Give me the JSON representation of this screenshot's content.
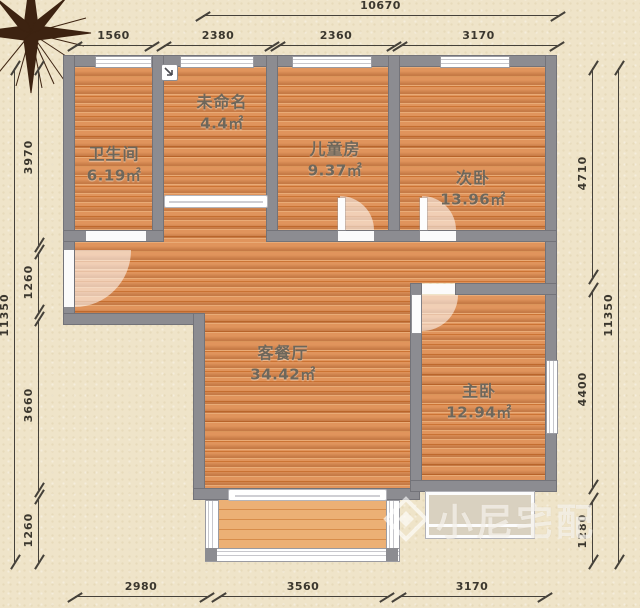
{
  "title": "apartment-floor-plan",
  "rooms": [
    {
      "id": "bathroom",
      "name": "卫生间",
      "area": "6.19㎡"
    },
    {
      "id": "unnamed",
      "name": "未命名",
      "area": "4.4㎡"
    },
    {
      "id": "kids-room",
      "name": "儿童房",
      "area": "9.37㎡"
    },
    {
      "id": "second-bedroom",
      "name": "次卧",
      "area": "13.96㎡"
    },
    {
      "id": "living-dining",
      "name": "客餐厅",
      "area": "34.42㎡"
    },
    {
      "id": "master-bedroom",
      "name": "主卧",
      "area": "12.94㎡"
    }
  ],
  "dimensions": {
    "top": {
      "total": "10670",
      "segments": [
        "1560",
        "2380",
        "2360",
        "3170"
      ]
    },
    "left": {
      "total": "11350",
      "segments": [
        "3970",
        "1260",
        "3660",
        "1260"
      ]
    },
    "right": {
      "total": "11350",
      "segments": [
        "4710",
        "4400",
        "1280"
      ]
    },
    "bottom": {
      "segments": [
        "2980",
        "3560",
        "3170"
      ]
    }
  },
  "watermark": {
    "text": "小尼宅配",
    "logo": "diamond-logo"
  },
  "icons": [
    "compass-rose-icon",
    "diamond-logo-icon",
    "corner-marker-icon"
  ],
  "colors": {
    "background": "#efe4c9",
    "wall": "#8c8c91",
    "floor_wood": "#d98648",
    "balcony_wood": "#ecb075",
    "dimension_text": "#3b372e",
    "room_label": "#6e675b",
    "compass": "#3d2311",
    "watermark": "rgba(255,255,255,0.62)"
  }
}
